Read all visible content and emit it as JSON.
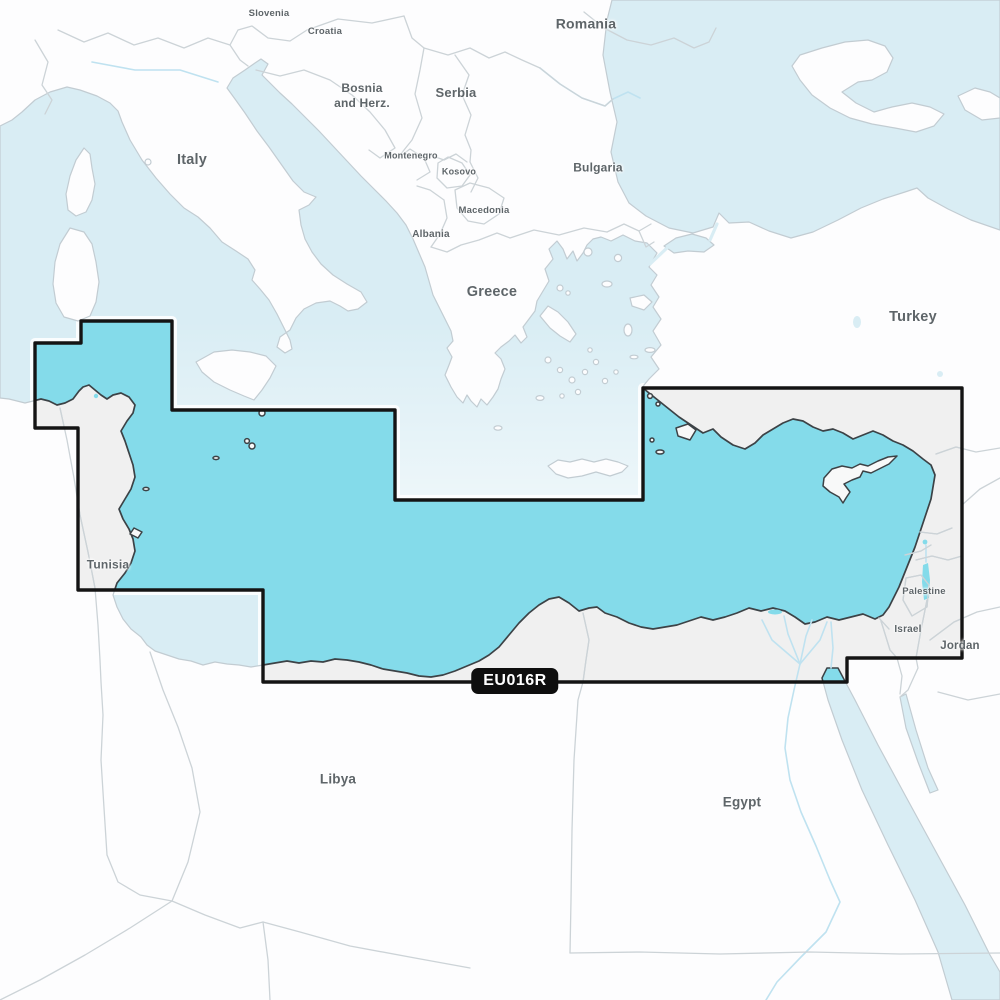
{
  "map": {
    "title": "Chart coverage map",
    "badge": {
      "text": "EU016R",
      "x": 515,
      "y": 681
    },
    "labels": [
      {
        "id": "slovenia",
        "text": "Slovenia",
        "x": 269,
        "y": 14,
        "size": 9.5
      },
      {
        "id": "croatia",
        "text": "Croatia",
        "x": 325,
        "y": 32,
        "size": 9.5
      },
      {
        "id": "bosnia",
        "text": "Bosnia\nand Herz.",
        "x": 362,
        "y": 96,
        "size": 12
      },
      {
        "id": "serbia",
        "text": "Serbia",
        "x": 456,
        "y": 93,
        "size": 13
      },
      {
        "id": "romania",
        "text": "Romania",
        "x": 586,
        "y": 24,
        "size": 14
      },
      {
        "id": "montenegro",
        "text": "Montenegro",
        "x": 411,
        "y": 156,
        "size": 9
      },
      {
        "id": "kosovo",
        "text": "Kosovo",
        "x": 459,
        "y": 172,
        "size": 9
      },
      {
        "id": "macedonia",
        "text": "Macedonia",
        "x": 484,
        "y": 211,
        "size": 9.5
      },
      {
        "id": "albania",
        "text": "Albania",
        "x": 431,
        "y": 235,
        "size": 10
      },
      {
        "id": "bulgaria",
        "text": "Bulgaria",
        "x": 598,
        "y": 168,
        "size": 12
      },
      {
        "id": "greece",
        "text": "Greece",
        "x": 492,
        "y": 292,
        "size": 14.5
      },
      {
        "id": "italy",
        "text": "Italy",
        "x": 192,
        "y": 160,
        "size": 14.5
      },
      {
        "id": "turkey",
        "text": "Turkey",
        "x": 913,
        "y": 317,
        "size": 14.5
      },
      {
        "id": "tunisia",
        "text": "Tunisia",
        "x": 108,
        "y": 565,
        "size": 12
      },
      {
        "id": "libya",
        "text": "Libya",
        "x": 338,
        "y": 780,
        "size": 13.5
      },
      {
        "id": "egypt",
        "text": "Egypt",
        "x": 742,
        "y": 803,
        "size": 13.5
      },
      {
        "id": "palestine",
        "text": "Palestine",
        "x": 924,
        "y": 592,
        "size": 9.5
      },
      {
        "id": "israel",
        "text": "Israel",
        "x": 908,
        "y": 630,
        "size": 10
      },
      {
        "id": "jordan",
        "text": "Jordan",
        "x": 960,
        "y": 646,
        "size": 11.5
      }
    ],
    "colors": {
      "sea_outside": "#d9edf4",
      "sea_covered": "#84dbea",
      "land_outside": "#fdfdfe",
      "land_covered": "#f0f0f0",
      "coast_outside": "#c2ccd2",
      "coast_covered": "#3c4246",
      "border_light": "#ccd3d7",
      "border_dark": "#7a8084",
      "river": "#bfe2f0",
      "coverage_boundary": "#141414",
      "boundary_halo": "#ffffff",
      "badge_bg": "#0e0e0e",
      "badge_text": "#ffffff",
      "label": "#5e6569"
    }
  }
}
